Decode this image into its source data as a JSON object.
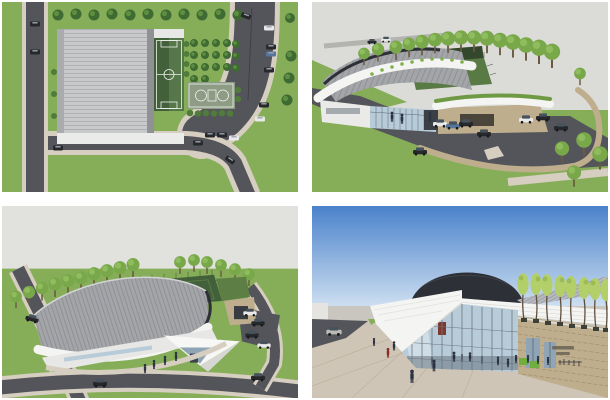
{
  "palette": {
    "page_bg": "#ffffff",
    "sky_overcast": "#dbdbd7",
    "sky_overcast2": "#e1e1dd",
    "sky_blue_top": "#4a82cb",
    "sky_blue_low": "#cfe0f1",
    "horizon": "#c9c6c0",
    "grass": "#86ae58",
    "tree_dark": "#3f6a33",
    "tree_mid": "#79a84b",
    "tree_bright": "#b2cf6a",
    "road": "#54555a",
    "sidewalk": "#d6cec0",
    "roof_light": "#c7c9cb",
    "roof_gray": "#a3a5a9",
    "fascia": "#f4f4f2",
    "dome": "#2d3036",
    "glass": "#b7cbd8",
    "glass_deep": "#8fa4b4",
    "stone": "#bfae8e",
    "pitch": "#42603a",
    "pitch_light": "#5a7a45",
    "court": "#8e9b85",
    "line_white": "#eef2ec",
    "car_dark": "#26282c",
    "car_white": "#e9e9e9",
    "car_blue": "#56759c",
    "person": "#2c3340",
    "person_red": "#8a2a22",
    "sign_green": "#6fae3f"
  },
  "views": [
    {
      "id": "site-plan",
      "label": "aerial site plan with pitch, court and parking"
    },
    {
      "id": "aerial-front",
      "label": "aerial perspective of leisure centre entrance and car park"
    },
    {
      "id": "aerial-rear",
      "label": "aerial perspective of barrel roof and rooftop pitch"
    },
    {
      "id": "entrance-view",
      "label": "ground level view of glazed entrance under blue sky"
    }
  ]
}
